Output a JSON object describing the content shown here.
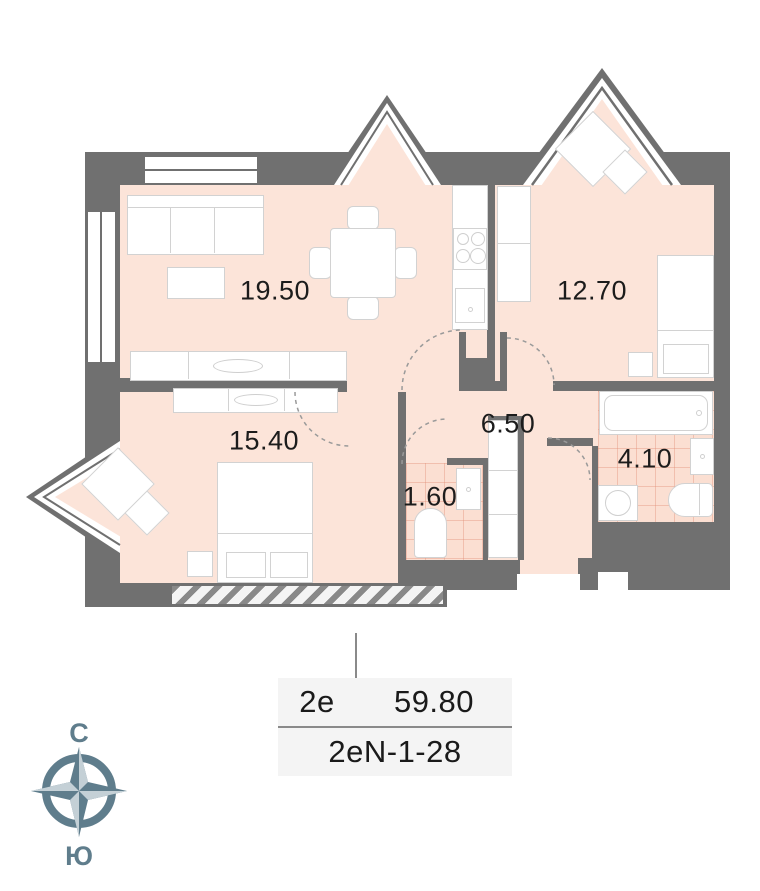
{
  "plan": {
    "rooms": [
      {
        "name": "living-room",
        "area": "19.50"
      },
      {
        "name": "bedroom-right",
        "area": "12.70"
      },
      {
        "name": "bedroom-left",
        "area": "15.40"
      },
      {
        "name": "hallway",
        "area": "6.50"
      },
      {
        "name": "wc",
        "area": "1.60"
      },
      {
        "name": "bathroom",
        "area": "4.10"
      }
    ]
  },
  "info_card": {
    "type_label": "2е",
    "total_area": "59.80",
    "unit_code": "2еN-1-28"
  },
  "compass": {
    "north": "С",
    "south": "Ю"
  },
  "colors": {
    "wall": "#707070",
    "floor": "#fce4d9",
    "tile_line": "#e08c73",
    "compass": "#5f7d8c",
    "card_bg": "#f4f4f4"
  }
}
